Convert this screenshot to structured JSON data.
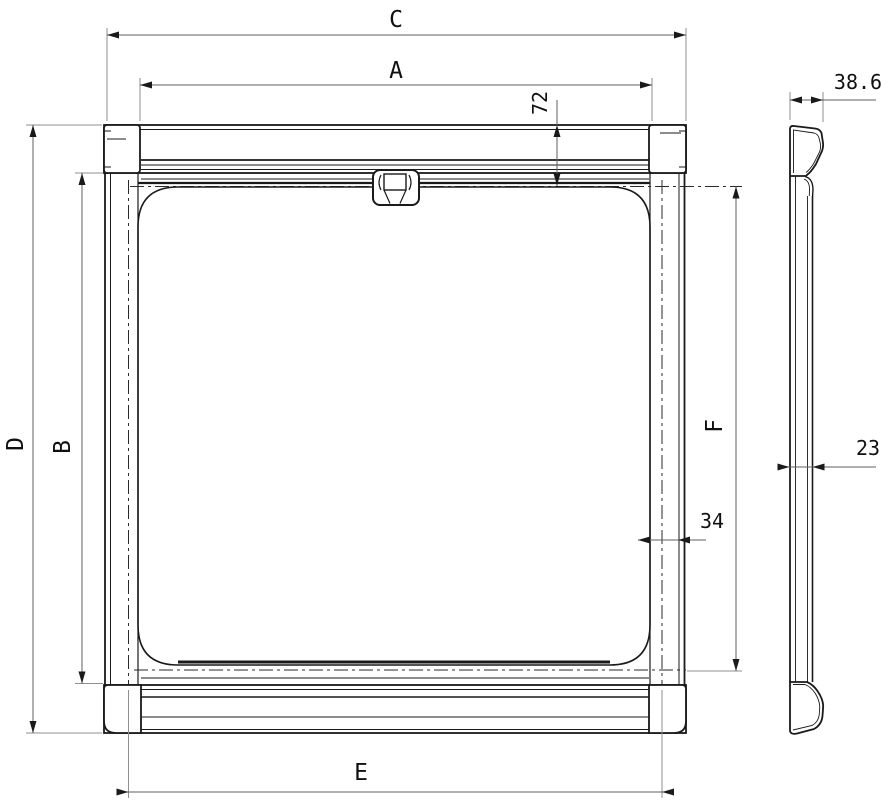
{
  "drawing": {
    "type": "technical-dimension-drawing",
    "views": {
      "front": "front-view",
      "side": "side-profile-view"
    },
    "labels": {
      "dim_c": "C",
      "dim_a": "A",
      "dim_e": "E",
      "dim_d": "D",
      "dim_b": "B",
      "dim_f": "F",
      "dim_72": "72",
      "dim_34": "34",
      "dim_23": "23",
      "dim_38_6": "38.6"
    },
    "dimensions": [
      {
        "label": "C",
        "orientation": "horizontal",
        "location": "top-outer"
      },
      {
        "label": "A",
        "orientation": "horizontal",
        "location": "top-inner"
      },
      {
        "label": "E",
        "orientation": "horizontal",
        "location": "bottom"
      },
      {
        "label": "D",
        "orientation": "vertical",
        "location": "left-outer"
      },
      {
        "label": "B",
        "orientation": "vertical",
        "location": "left-inner"
      },
      {
        "label": "F",
        "orientation": "vertical",
        "location": "right-inner"
      },
      {
        "label": "72",
        "orientation": "vertical",
        "location": "top-housing"
      },
      {
        "label": "34",
        "orientation": "horizontal",
        "location": "right-jamb"
      },
      {
        "label": "23",
        "orientation": "horizontal",
        "location": "side-profile-thickness"
      },
      {
        "label": "38.6",
        "orientation": "horizontal",
        "location": "side-profile-depth"
      }
    ],
    "colors": {
      "background": "#ffffff",
      "part_line": "#1a1a1a",
      "dim_line": "#5f5f5f",
      "ext_line": "#8f8f8f",
      "text": "#101010"
    }
  }
}
